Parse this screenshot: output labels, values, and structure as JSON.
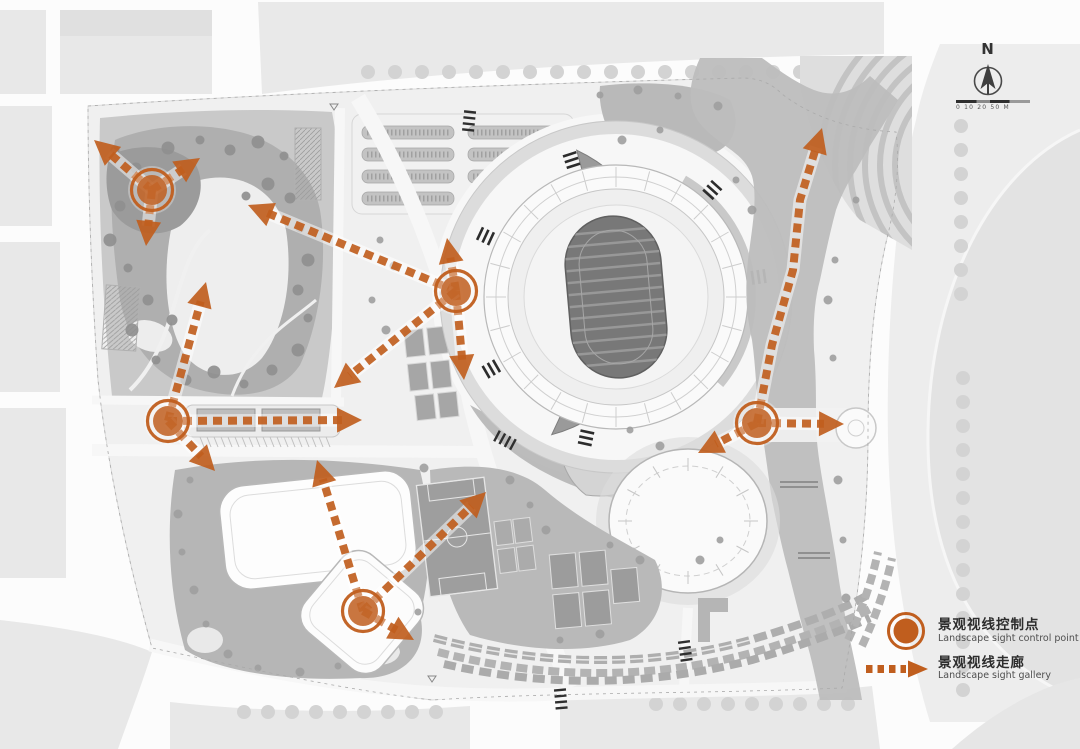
{
  "compass": {
    "label": "N",
    "scale_text": "0 10 20 50 M"
  },
  "legend": {
    "items": [
      {
        "id": "control-point",
        "zh": "景观视线控制点",
        "en": "Landscape sight control point"
      },
      {
        "id": "sight-corridor",
        "zh": "景观视线走廊",
        "en": "Landscape sight gallery"
      }
    ]
  },
  "colors": {
    "accent": "#C05E1E"
  },
  "diagram": {
    "control_points": [
      {
        "x": 152,
        "y": 190
      },
      {
        "x": 456,
        "y": 291
      },
      {
        "x": 168,
        "y": 421
      },
      {
        "x": 363,
        "y": 611
      },
      {
        "x": 757,
        "y": 423
      }
    ],
    "corridors": [
      {
        "pts": [
          [
            152,
            190
          ],
          [
            94,
            140
          ]
        ]
      },
      {
        "pts": [
          [
            152,
            190
          ],
          [
            200,
            158
          ]
        ]
      },
      {
        "pts": [
          [
            152,
            190
          ],
          [
            146,
            246
          ]
        ]
      },
      {
        "pts": [
          [
            456,
            291
          ],
          [
            248,
            205
          ]
        ]
      },
      {
        "pts": [
          [
            456,
            291
          ],
          [
            447,
            238
          ]
        ]
      },
      {
        "pts": [
          [
            456,
            291
          ],
          [
            464,
            380
          ]
        ]
      },
      {
        "pts": [
          [
            456,
            291
          ],
          [
            334,
            388
          ]
        ]
      },
      {
        "pts": [
          [
            168,
            421
          ],
          [
            206,
            282
          ]
        ]
      },
      {
        "pts": [
          [
            168,
            421
          ],
          [
            362,
            420
          ]
        ]
      },
      {
        "pts": [
          [
            168,
            421
          ],
          [
            215,
            471
          ]
        ]
      },
      {
        "pts": [
          [
            363,
            611
          ],
          [
            317,
            460
          ]
        ]
      },
      {
        "pts": [
          [
            363,
            611
          ],
          [
            486,
            492
          ]
        ]
      },
      {
        "pts": [
          [
            363,
            611
          ],
          [
            414,
            640
          ]
        ]
      },
      {
        "pts": [
          [
            757,
            423
          ],
          [
            844,
            424
          ]
        ]
      },
      {
        "pts": [
          [
            757,
            423
          ],
          [
            698,
            453
          ]
        ]
      },
      {
        "pts": [
          [
            757,
            423
          ],
          [
            772,
            345
          ],
          [
            793,
            270
          ],
          [
            800,
            200
          ],
          [
            822,
            128
          ]
        ]
      }
    ]
  }
}
